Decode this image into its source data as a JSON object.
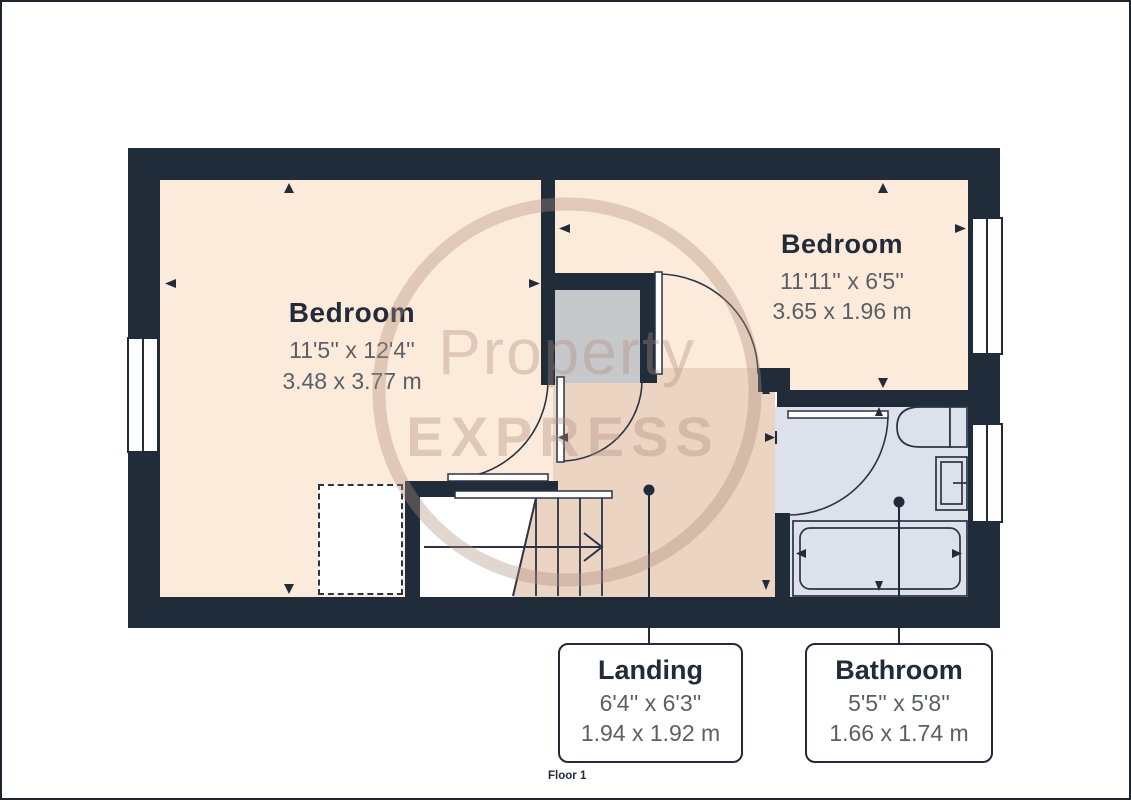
{
  "plan": {
    "floor_label": "Floor 1",
    "watermark": {
      "line1": "Property",
      "line2": "EXPRESS"
    },
    "rooms": {
      "bedroom_left": {
        "name": "Bedroom",
        "dims_imperial": "11'5'' x 12'4''",
        "dims_metric": "3.48 x 3.77 m"
      },
      "bedroom_right": {
        "name": "Bedroom",
        "dims_imperial": "11'11'' x 6'5''",
        "dims_metric": "3.65 x 1.96 m"
      },
      "landing": {
        "name": "Landing",
        "dims_imperial": "6'4'' x 6'3''",
        "dims_metric": "1.94 x 1.92 m"
      },
      "bathroom": {
        "name": "Bathroom",
        "dims_imperial": "5'5'' x 5'8''",
        "dims_metric": "1.66 x 1.74 m"
      }
    },
    "colors": {
      "wall": "#212c3b",
      "bedroom_fill": "#fcebdb",
      "landing_fill": "#ecd4c3",
      "bathroom_fill": "#dce1ec",
      "closet_fill": "#c7c8ca",
      "outline": "#2a3444",
      "title_text": "#222b39",
      "dims_text": "#5a6067",
      "watermark": "#b08d7d"
    }
  }
}
